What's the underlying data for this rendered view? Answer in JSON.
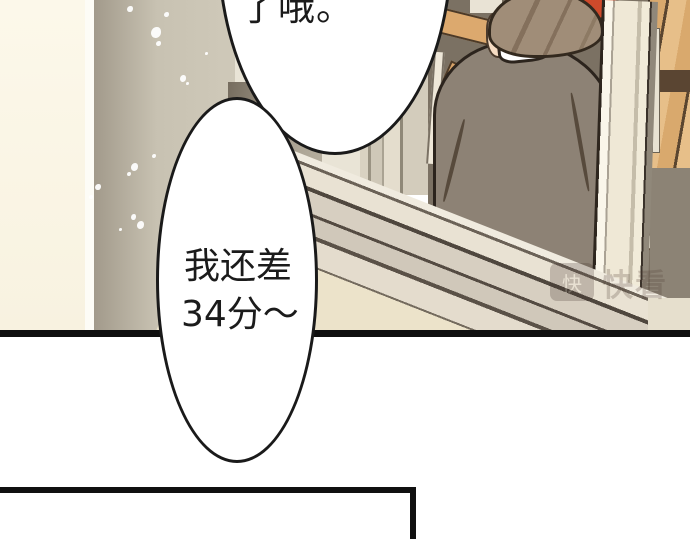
{
  "bubbles": {
    "top": {
      "text": "了哦。"
    },
    "middle": {
      "line1": "我还差",
      "line2": "34分～"
    }
  },
  "watermark": {
    "logo_char": "快",
    "brand": "快看"
  },
  "colors": {
    "ink": "#1a1a1a",
    "paper": "#ffffff",
    "wall_cream": "#f8f2e0",
    "wall_gray": "#c8c2b2",
    "frame_light": "#e9e4d6",
    "classroom_bg": "#7b7163",
    "wood": "#dca96e",
    "wood_bright": "#e3b37e",
    "jacket": "#8d8275",
    "hair": "#a08d78",
    "skin": "#f6dcc3",
    "red_bag": "#cf4a2b",
    "sill_cream": "#ece3ca",
    "shadow_dark": "#5a5045"
  }
}
